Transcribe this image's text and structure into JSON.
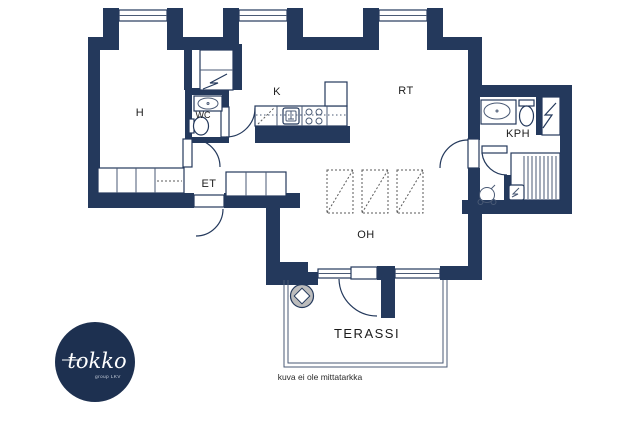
{
  "plan": {
    "rooms": {
      "h": "H",
      "wc": "WC",
      "k": "K",
      "rt": "RT",
      "et": "ET",
      "oh": "OH",
      "kph": "KPH",
      "terassi": "TERASSI"
    },
    "disclaimer": "kuva ei ole mittatarkka",
    "colors": {
      "wall": "#24395c",
      "background": "#ffffff",
      "fixture_line": "#24395c",
      "reservation_dash": "#5a5a5a",
      "grill_fill": "#bdbdbd",
      "logo_circle": "#1d3050"
    },
    "icons": [
      "window",
      "door-arc",
      "sink",
      "toilet",
      "stove-burners",
      "dishwasher-reservation",
      "electrical-panel-zigzag",
      "sauna-benches",
      "sauna-stove",
      "floor-drain-shower",
      "wardrobe",
      "grill"
    ]
  },
  "logo": {
    "brand": "tokko",
    "tagline": "group LKV"
  }
}
